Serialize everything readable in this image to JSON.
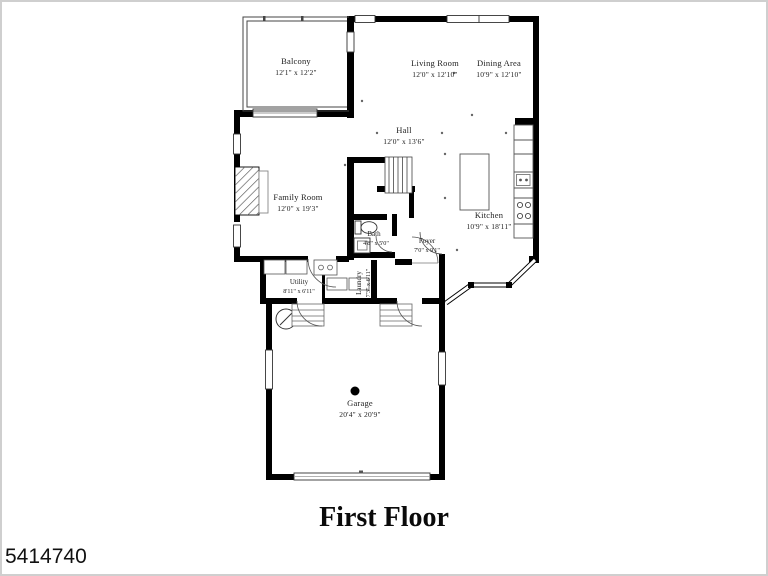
{
  "page": {
    "title": "First Floor",
    "listing_id": "5414740"
  },
  "rooms": [
    {
      "id": "balcony",
      "name": "Balcony",
      "dims": "12'1\" x 12'2\""
    },
    {
      "id": "living-room",
      "name": "Living Room",
      "dims": "12'0\" x 12'10\""
    },
    {
      "id": "dining-area",
      "name": "Dining Area",
      "dims": "10'9\" x 12'10\""
    },
    {
      "id": "hall",
      "name": "Hall",
      "dims": "12'0\" x 13'6\""
    },
    {
      "id": "family-room",
      "name": "Family Room",
      "dims": "12'0\" x 19'3\""
    },
    {
      "id": "kitchen",
      "name": "Kitchen",
      "dims": "10'9\" x 18'11\""
    },
    {
      "id": "bath",
      "name": "Bath",
      "dims": "4'8\" x 5'0\""
    },
    {
      "id": "foyer",
      "name": "Foyer",
      "dims": "7'0\" x 9'1\""
    },
    {
      "id": "utility",
      "name": "Utility",
      "dims": "8'11\" x 6'11\""
    },
    {
      "id": "laundry",
      "name": "Laundry",
      "dims": "7'3\" x 6'11\""
    },
    {
      "id": "garage",
      "name": "Garage",
      "dims": "20'4\" x 20'9\""
    }
  ],
  "colors": {
    "walls": "#000000",
    "background": "#ffffff",
    "thin_lines": "#444444",
    "frame": "#cfcfcf"
  }
}
